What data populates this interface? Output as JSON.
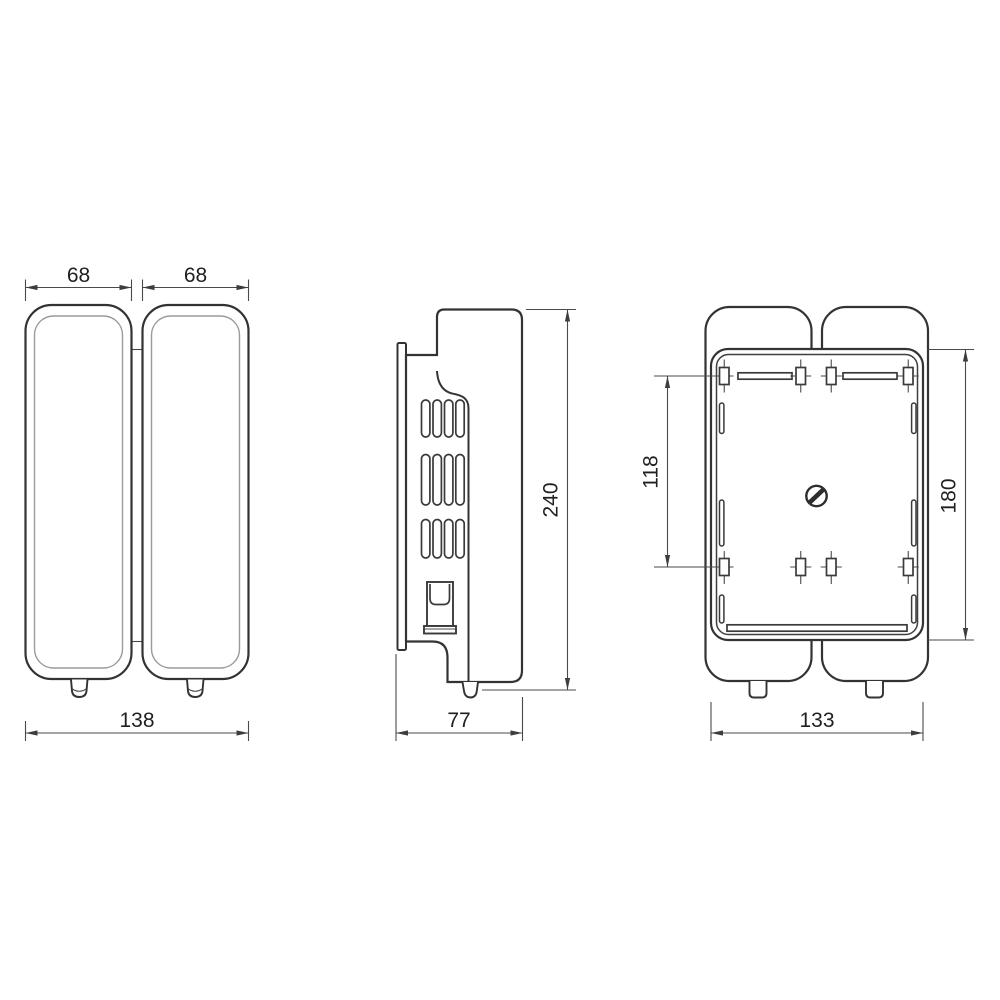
{
  "drawing": {
    "type": "technical-orthographic-projection",
    "subject": "wall-mounted double dispenser, three dimensioned views",
    "units_shown": false,
    "views": {
      "front": {
        "label": "front view",
        "dim_left_body_width": "68",
        "dim_right_body_width": "68",
        "dim_total_width": "138"
      },
      "side": {
        "label": "side view",
        "dim_height": "240",
        "dim_depth": "77"
      },
      "back": {
        "label": "back mounting plate view",
        "dim_hole_spacing": "118",
        "dim_plate_height": "180",
        "dim_plate_width": "133"
      }
    },
    "dims": {
      "front_left": "68",
      "front_right": "68",
      "front_total": "138",
      "side_height": "240",
      "side_depth": "77",
      "back_holes": "118",
      "back_height": "180",
      "back_width": "133"
    },
    "colors": {
      "background": "#ffffff",
      "outline": "#333333",
      "inner_line": "#9a9a9a",
      "dimension_line": "#4a4a4a",
      "text": "#1f1f1f"
    }
  }
}
